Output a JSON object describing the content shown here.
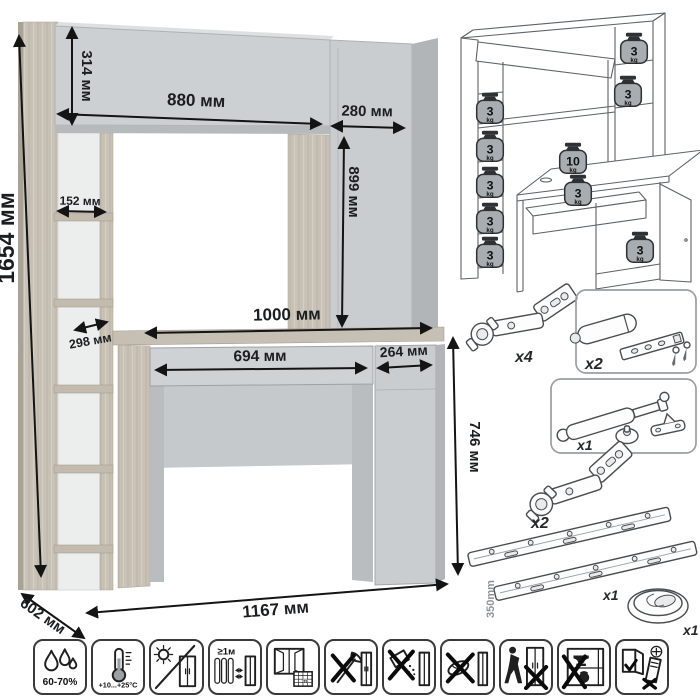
{
  "figure": {
    "type": "furniture dimension sheet",
    "product": "desk with hutch and side shelving",
    "unit": "мм"
  },
  "dimensions": {
    "total_height": "1654 мм",
    "hutch_door_height": "314 мм",
    "hutch_width": "880 мм",
    "side_column_width": "280 мм",
    "shelf_depth_upper": "152 мм",
    "side_column_height": "899 мм",
    "shelf_depth_lower": "298 мм",
    "desktop_width": "1000 мм",
    "drawer_width": "694 мм",
    "door_width": "264 мм",
    "desk_height": "746 мм",
    "depth": "602 мм",
    "total_width": "1167 мм"
  },
  "load_diagram": {
    "weights": [
      {
        "value": "3",
        "unit": "kg",
        "location": "left shelf 1"
      },
      {
        "value": "3",
        "unit": "kg",
        "location": "left shelf 2"
      },
      {
        "value": "3",
        "unit": "kg",
        "location": "left shelf 3"
      },
      {
        "value": "3",
        "unit": "kg",
        "location": "left shelf 4"
      },
      {
        "value": "3",
        "unit": "kg",
        "location": "left shelf 5"
      },
      {
        "value": "3",
        "unit": "kg",
        "location": "hutch top shelf"
      },
      {
        "value": "3",
        "unit": "kg",
        "location": "hutch side shelf"
      },
      {
        "value": "10",
        "unit": "kg",
        "location": "desktop"
      },
      {
        "value": "3",
        "unit": "kg",
        "location": "drawer"
      },
      {
        "value": "3",
        "unit": "kg",
        "location": "base cabinet"
      }
    ]
  },
  "hardware": {
    "items": [
      {
        "name": "concealed hinge",
        "qty": "x4"
      },
      {
        "name": "door damper with strike plate and screws",
        "qty": "x2"
      },
      {
        "name": "gas lift strut with fittings",
        "qty": "x1"
      },
      {
        "name": "concealed hinge",
        "qty": "x2"
      },
      {
        "name": "ball-bearing drawer slides",
        "qty": "x1",
        "length": "350mm"
      },
      {
        "name": "cable grommet",
        "qty": "x1"
      }
    ]
  },
  "care_icons": [
    {
      "name": "humidity-range",
      "text": "60-70%"
    },
    {
      "name": "temperature-range",
      "text": "+10...+25°C"
    },
    {
      "name": "no-direct-sunlight",
      "text": ""
    },
    {
      "name": "keep-distance-from-heaters",
      "text": "≥1м"
    },
    {
      "name": "ventilate-room",
      "text": "21"
    },
    {
      "name": "no-sharp-objects",
      "text": ""
    },
    {
      "name": "no-abrasive-cleaners",
      "text": ""
    },
    {
      "name": "no-wet-cleaning",
      "text": ""
    },
    {
      "name": "no-dragging",
      "text": ""
    },
    {
      "name": "no-overloading",
      "text": ""
    },
    {
      "name": "check-door-alignment",
      "text": ""
    }
  ]
}
